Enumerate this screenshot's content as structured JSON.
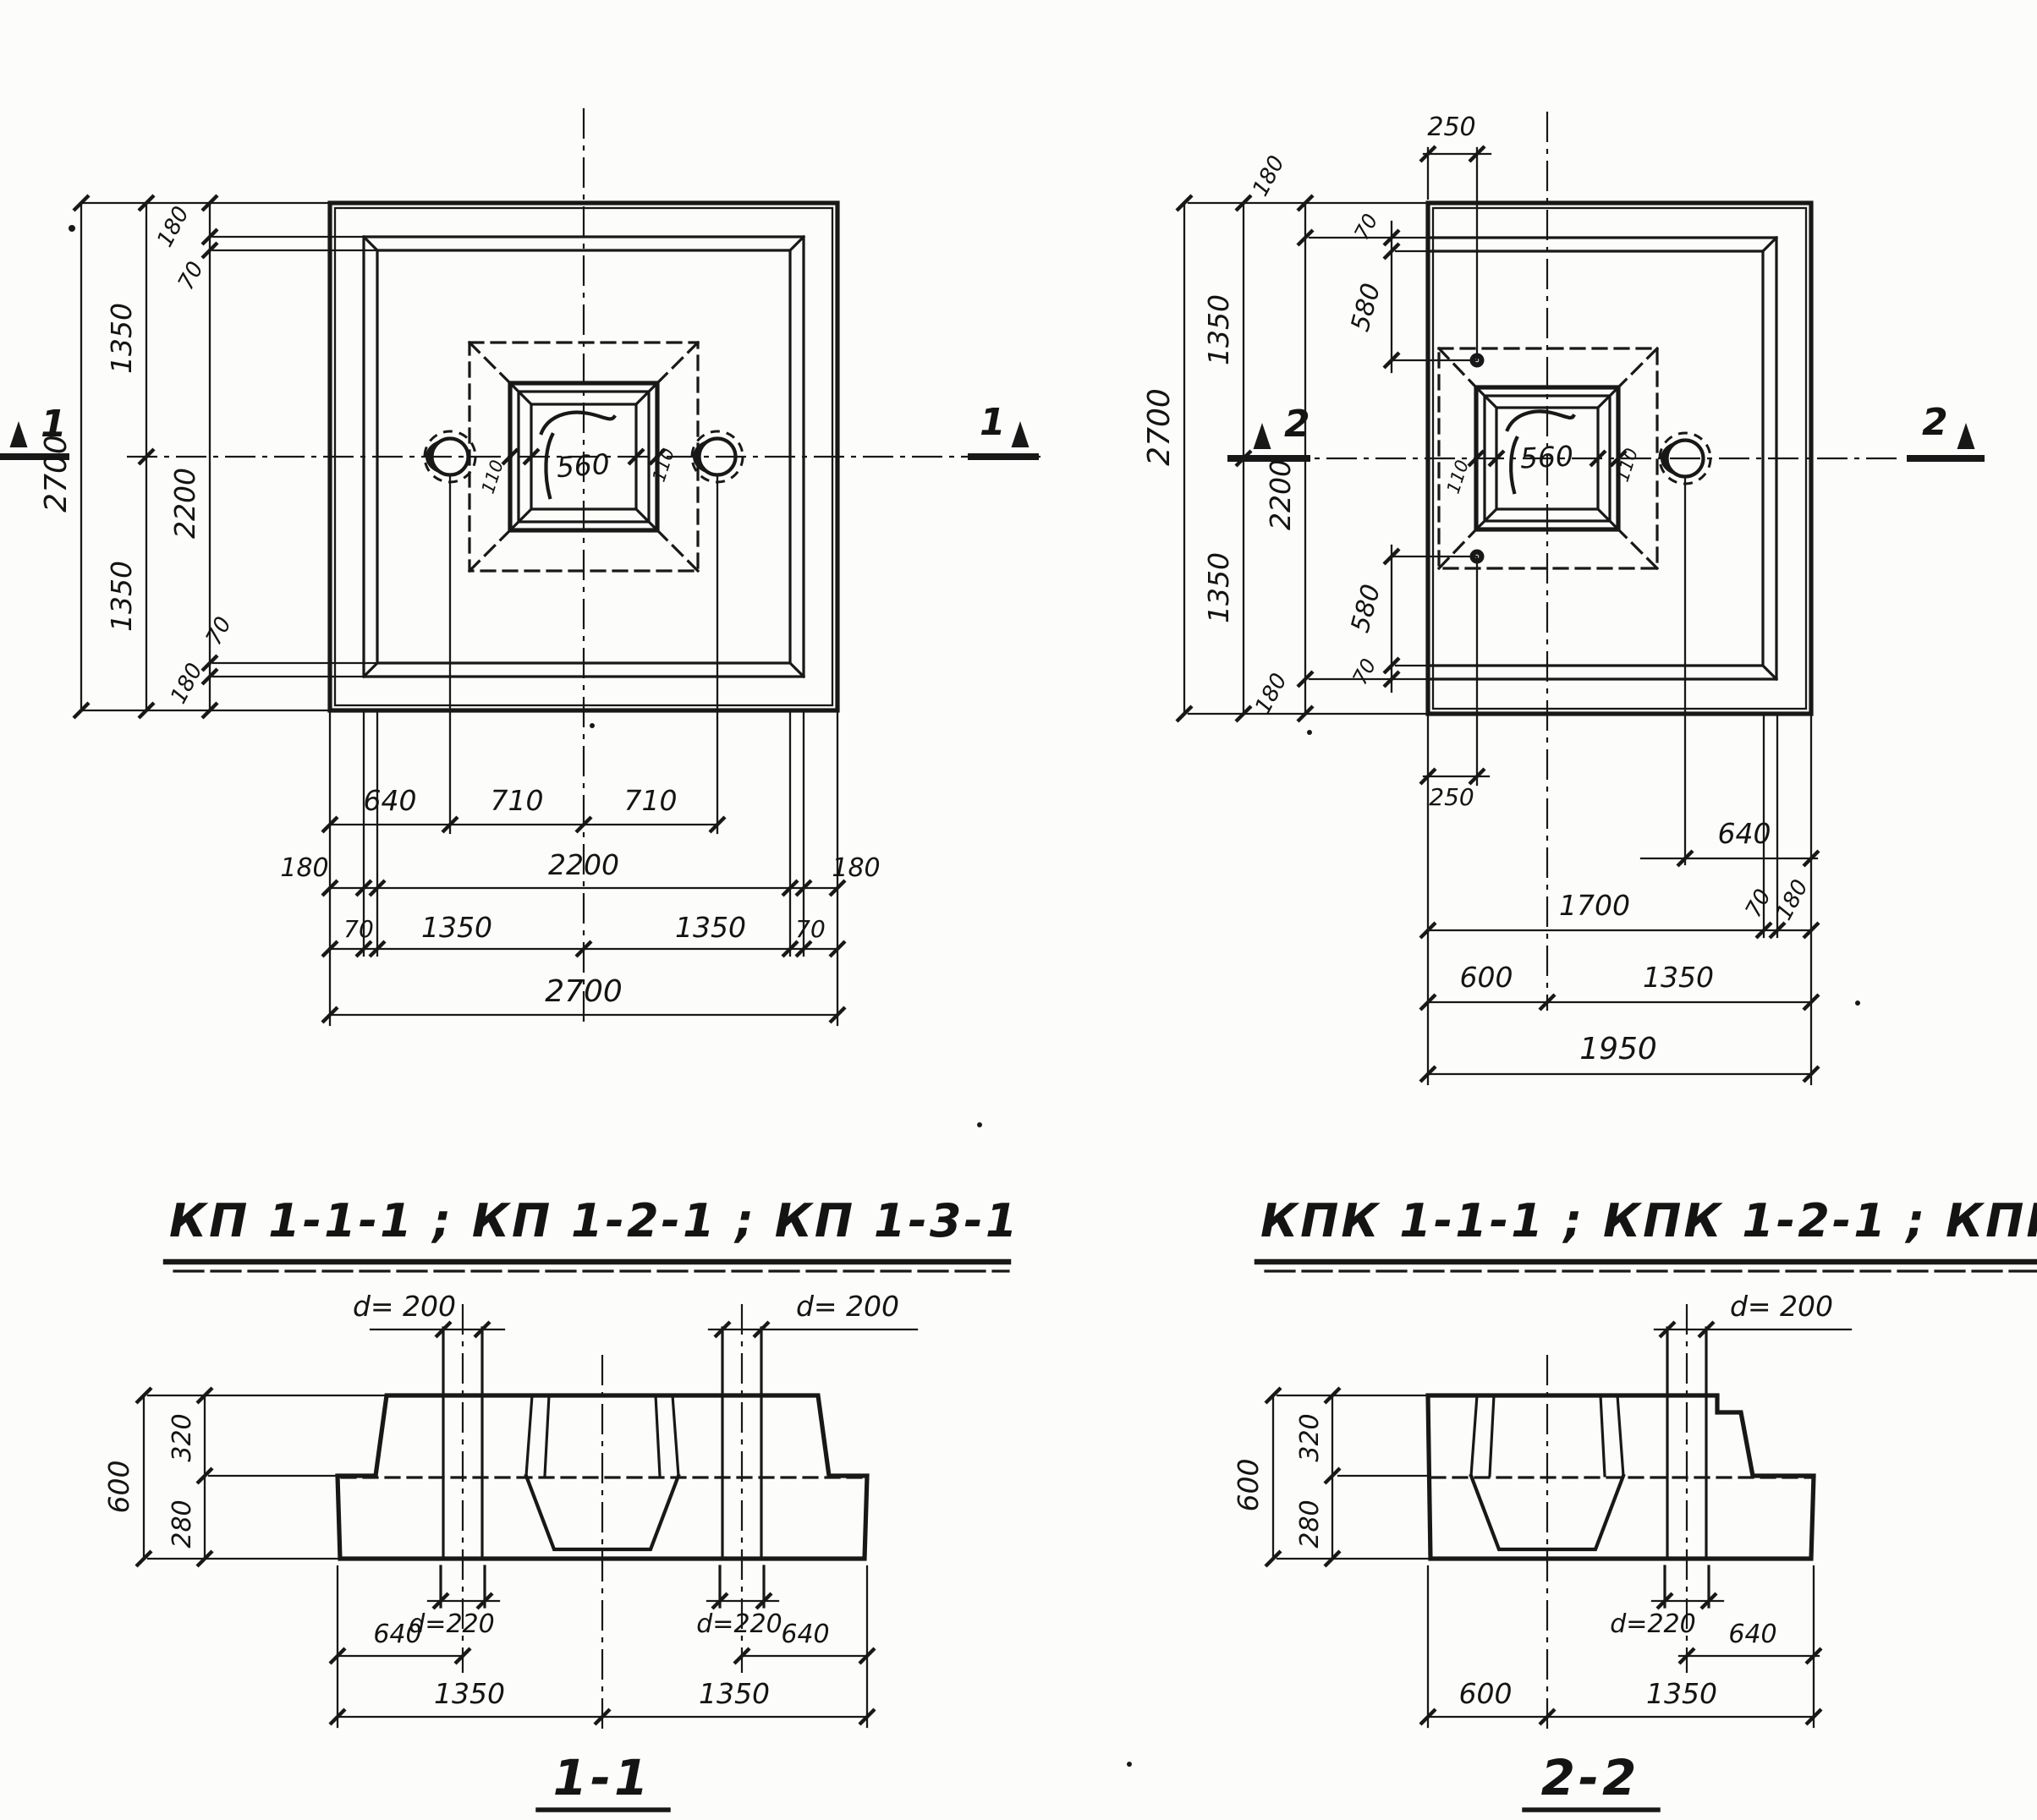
{
  "titles": {
    "left": "КП 1-1-1 ; КП 1-2-1 ;  КП 1-3-1",
    "right": "КПК 1-1-1 ; КПК 1-2-1 ; КПК 1-3-1"
  },
  "section_labels": {
    "s1": "1-1",
    "s2": "2-2"
  },
  "cut_marks": {
    "one": "1",
    "two": "2"
  },
  "plan_left": {
    "left_chain": {
      "total": "2700",
      "half_top": "1350",
      "half_bottom": "1350",
      "inner": "2200",
      "edge_top": "180",
      "step_top": "70",
      "step_bottom": "70",
      "edge_bottom": "180"
    },
    "bottom_chain": {
      "hole_edge": "640",
      "hole_to_center": "710",
      "center_to_hole": "710",
      "edge_left": "180",
      "inner": "2200",
      "edge_right": "180",
      "step_left": "70",
      "half_left": "1350",
      "half_right": "1350",
      "step_right": "70",
      "total": "2700"
    },
    "socket": {
      "lip_left": "110",
      "width": "560",
      "lip_right": "110"
    }
  },
  "plan_right": {
    "top_offset": "250",
    "left_chain": {
      "total": "2700",
      "half_top": "1350",
      "half_bottom": "1350",
      "inner": "2200",
      "edge_top": "180",
      "step_top": "70",
      "hole_top": "580",
      "hole_bottom": "580",
      "step_bottom": "70",
      "edge_bottom": "180"
    },
    "bottom_chain": {
      "offset": "250",
      "hole_edge": "640",
      "width_to_step": "1700",
      "step": "70",
      "edge": "180",
      "axis": "600",
      "half": "1350",
      "total": "1950"
    },
    "socket": {
      "lip_left": "110",
      "width": "560",
      "lip_right": "110"
    }
  },
  "section_1_1": {
    "dia_top_left": "d= 200",
    "dia_top_right": "d= 200",
    "dia_bot_left": "d=220",
    "dia_bot_right": "d=220",
    "height_total": "600",
    "height_top": "320",
    "height_bottom": "280",
    "edge_left": "640",
    "edge_right": "640",
    "half_left": "1350",
    "half_right": "1350"
  },
  "section_2_2": {
    "dia_top": "d= 200",
    "dia_bot": "d=220",
    "height_total": "600",
    "height_top": "320",
    "height_bottom": "280",
    "edge": "640",
    "axis": "600",
    "half": "1350"
  }
}
